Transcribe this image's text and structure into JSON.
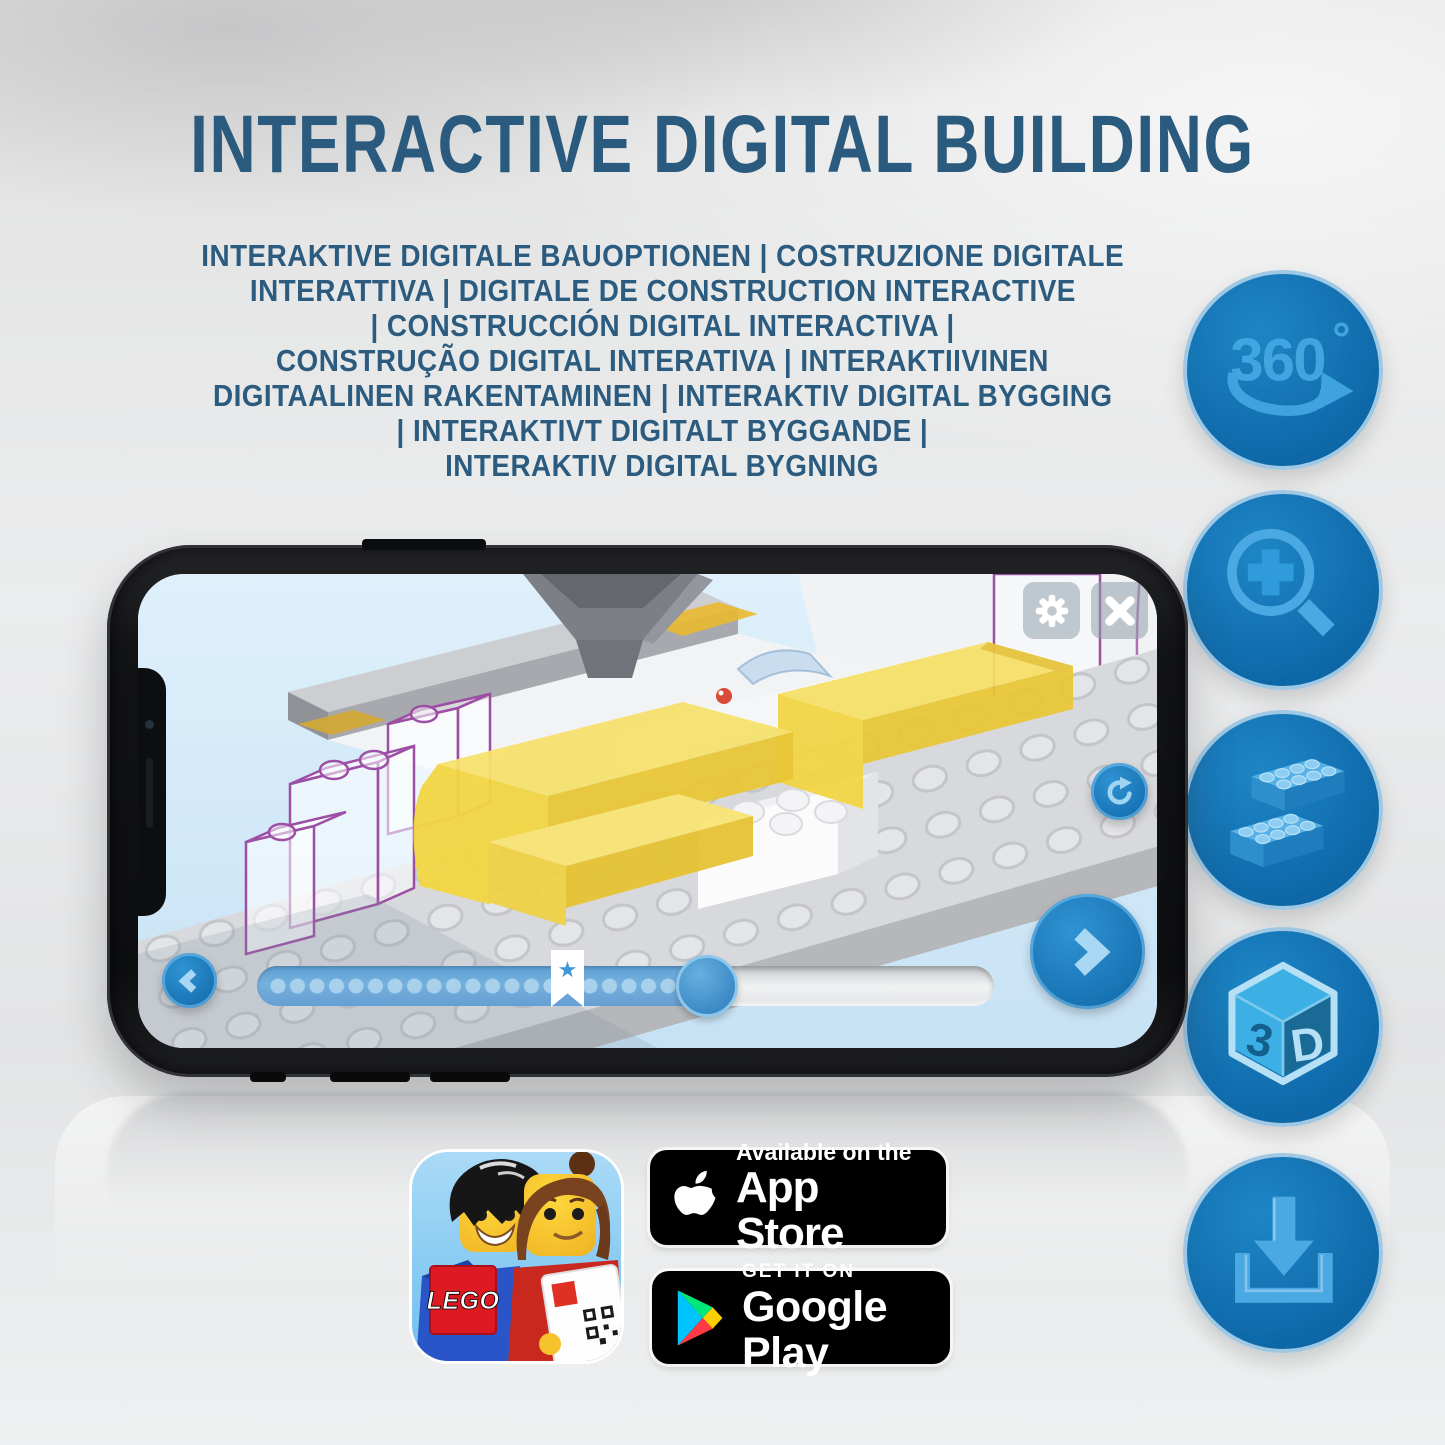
{
  "page": {
    "title": "INTERACTIVE DIGITAL BUILDING",
    "subtitle_lines": [
      "INTERAKTIVE DIGITALE BAUOPTIONEN | COSTRUZIONE DIGITALE",
      "INTERATTIVA | DIGITALE DE CONSTRUCTION INTERACTIVE",
      "| CONSTRUCCIÓN DIGITAL INTERACTIVA |",
      "CONSTRUÇÃO DIGITAL INTERATIVA | INTERAKTIIVINEN",
      "DIGITAALINEN RAKENTAMINEN | INTERAKTIV DIGITAL BYGGING",
      "| INTERAKTIVT DIGITALT BYGGANDE |",
      "INTERAKTIV DIGITAL BYGNING"
    ]
  },
  "features": {
    "rotation_value": "360",
    "rotation_degree": "°",
    "cube_left": "3",
    "cube_right": "D"
  },
  "phone_app": {
    "slider": {
      "progress_percent": 61,
      "bookmark_percent": 42
    }
  },
  "badges": {
    "app_store": {
      "tagline": "Available on the",
      "store": "App Store"
    },
    "google_play": {
      "tagline": "GET IT ON",
      "store": "Google Play"
    }
  },
  "app_icon": {
    "logo_text": "LEGO"
  },
  "colors": {
    "heading_blue": "#2a5a7d",
    "circle_blue": "#1173b9",
    "glyph_light_blue": "#45a7e3",
    "screen_bg": "#d8eaf8",
    "brick_yellow": "#f2d23c",
    "ghost_outline_purple": "#9c4fa4"
  }
}
